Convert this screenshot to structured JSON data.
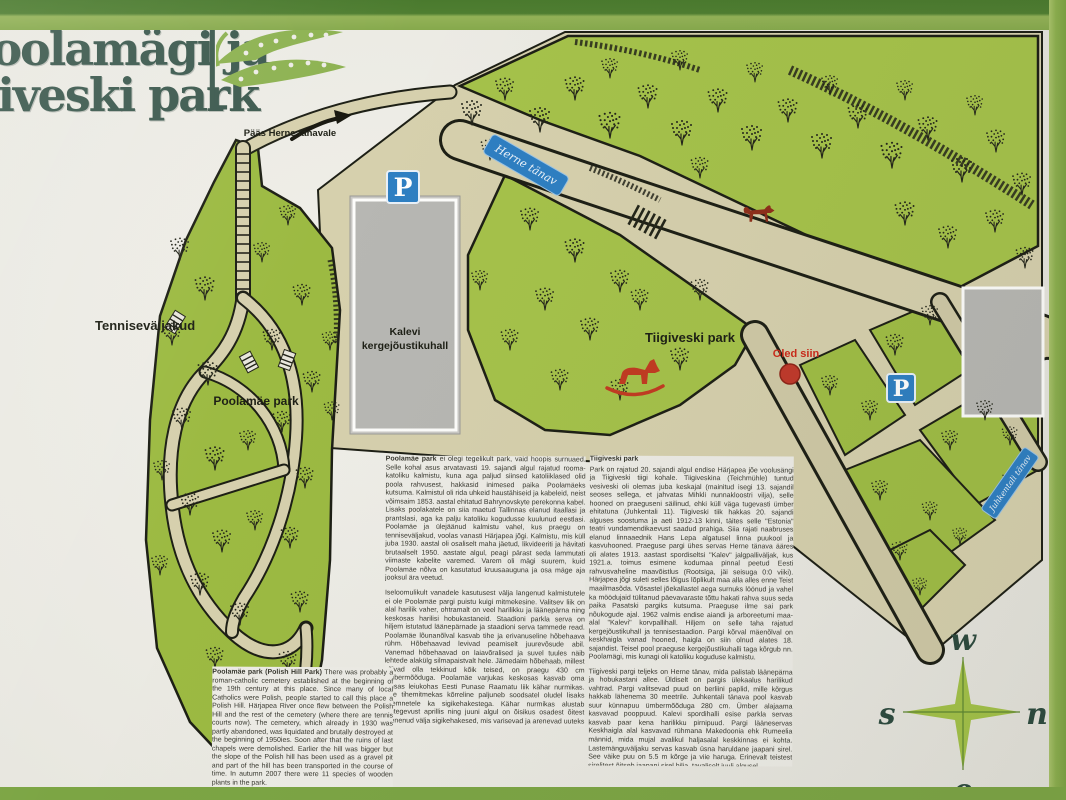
{
  "sign": {
    "title": {
      "line1": "Poolamägi ja",
      "line2": "Tiigiveski park"
    },
    "entrance_note": "Pääs Herne tänavale",
    "map": {
      "area_labels": {
        "tennis_courts": "Tenniseväljakud",
        "sports_hall_line1": "Kalevi",
        "sports_hall_line2": "kergejõustikuhall",
        "poolamae_park": "Poolamäe park",
        "tiigiveski_park": "Tiigiveski park"
      },
      "street_signs": {
        "herne": "Herne tänav",
        "juhkentali": "Juhkentali tänav"
      },
      "parking_symbol": "P",
      "you_are_here": "Oled siin",
      "compass": {
        "top": "w",
        "left": "s",
        "right": "n",
        "bottom": "e"
      }
    },
    "text_blocks": {
      "poolamae_et": {
        "lead": "Poolamäe park",
        "para1": "ei olegi tegelikult park, vaid hoopis surnuaed. Selle kohal asus arvatavasti 19. sajandi algul rajatud rooma-katoliku kalmistu, kuna aga paljud siinsed katoliiklased olid poola rahvusest, hakkasid inimesed paika Poolamäeks kutsuma. Kalmistul oli rida uhkeid haustähiseid ja kabeleid, neist võimsaim 1853. aastal ehitatud Bahrynovskyte perekonna kabel. Lisaks poolakatele on siia maetud Tallinnas elanud itaallasi ja prantslasi, aga ka palju katoliku kogudusse kuulunud eestlasi. Poolamäe ja ülejäänud kalmistu vahel, kus praegu on tenniseväljakud, voolas vanasti Härjapea jõgi. Kalmistu, mis küll juba 1930. aastal oli osaliselt maha jäetud, likvideeriti ja hävitati brutaalselt 1950. aastate algul, peagi pärast seda lammutati viimaste kabelite varemed. Varem oli mägi suurem, kuid Poolamäe nõlva on kasutatud kruusaauguna ja osa mäge aja jooksul ära veetud.",
        "para2": "Iseloomulikult vanadele kasutusest välja langenud kalmistutele ei ole Poolamäe pargi puistu kuigi mitmekesine. Valitsev liik on alal harilik vaher, ohtramalt on veel harilikku ja läänepärna ning keskosas harilisi hobukastaneid. Staadioni parkla serva on hiljem istutatud läänepärnade ja staadioni serva tammede read. Poolamäe lõunanõlval kasvab tihe ja erivanuseline hõbehaava rühm. Hõbehaavad levivad peamiselt juurevõsude abil. Vanemad hõbehaavad on laiavõralised ja suvel tuules näib lehtede alakülg silmapaistvalt hele. Jämedaim hõbehaab, millest võivad olla tekkinud kõik teised, on praegu 430 cm ümbermõõduga. Poolamäe varjukas keskosas kasvab oma ainsas leiukohas Eesti Punase Raamatu liik kähar nurmikas. See tihemitmekas kõrreline paljuneb soodsatel oludel lisaks seemnetele ka sigikehakestega. Kähar nurmikas alustab elutegevust aprillis ning juuni algul on õisikus osadest õitest arenenud välja sigikehakesed, mis varisevad ja arenevad uuteks taimedeks. Liigi säilimiseks ei tohiks pargi keskosas niita enne jaanipäeva.",
        "para3": "2007. a. sügisel kasvas pargis 11 nimetust puittaimi."
      },
      "tiigiveski_et": {
        "heading": "Tiigiveski park",
        "para1": "Park on rajatud 20. sajandi algul endise Härjapea jõe voolusängi ja Tiigiveski tiigi kohale. Tiigiveskina (Teichmühle) tuntud vesiveski oli olemas juba keskajal (mainitud isegi 13. sajandil seoses sellega, et jahvatas Mihkli nunnakloostri vilja), selle hooned on praeguseni säilinud, ehki küll väga tugevasti ümber ehitatuna (Juhkentali 11). Tiigiveski tiik hakkas 20. sajandi alguses soostuma ja aeti 1912-13 kinni, täites selle \"Estonia\" teatri vundamendikaevust saadud prahiga. Siia rajati naabruses elanud linnaaednik Hans Lepa algatusel linna puukool ja kasvuhooned. Praeguse pargi ühes servas Herne tänava ääres oli alates 1913. aastast spordiseltsi \"Kalev\" jalgpalliväljak, kus 1921.a. toimus esimene kodumaa pinnal peetud Eesti rahvusvaheline maavõistlus (Rootsiga, jäi seisuga 0:0 viiki). Härjapea jõgi suleti selles lõigus lõplikult maa alla alles enne Teist maailmasõda. Võsastel jõekallastel aega surnuks löönud ja vahel ka möödujaid tülitanud päevavaraste tõttu hakati rahva suus seda paika Pasatski pargiks kutsuma. Praeguse ilme sai park nõukogude ajal. 1962 valmis endise aiandi ja arboreetumi maa-alal \"Kalevi\" korvpallihall. Hiljem on selle taha rajatud kergejõustikuhall ja tennisestaadion. Pargi kõrval mäenõlval on keskhaigla vanad hooned, haigla on siin olnud alates 18. sajandist. Teisel pool praeguse kergejõustikuhalli taga kõrgub nn. Poolamägi, mis kunagi oli katoliku koguduse kalmistu.",
        "para2": "Tiigiveski pargi teljeks on Herne tänav, mida palistab läänepärna ja hobukastani allee. Üldiselt on pargis ülekaalus harilikud vahtrad. Pargi valitsevad puud on berliini paplid, mille kõrgus hakkab lähenema 30 meetrile. Juhkentali tänava pool kasvab suur künnapuu ümbermõõduga 280 cm. Ümber alajaama kasvavad pooppuud. Kalevi spordihalli esise parkla servas kasvab paar kena harilikku pirnipuud. Pargi lääneservas Keskhaigla alal kasvavad rühmana Makedoonia ehk Rumeelia männid, mida mujal avalikul haljasalal keskkinnas ei kohta. Lastemänguväljaku servas kasvab üsna haruldane jaapani sirel. See väike puu on 5.5 m kõrge ja viie haruga. Erinevalt teistest sirelitest õitseb jaapani sirel hilja, tavaliselt juuli algusel.",
        "para3": "2007. a. sügisel oli pargis 20 erinevat puittaime."
      },
      "poolamae_en": {
        "lead": "Poolamäe park (Polish Hill Park)",
        "para1": "There was probably a roman-catholic cemetery established at the beginning of the 19th century at this place. Since many of local Catholics were Polish, people started to call this place a Polish Hill. Härjapea River once flew between the Polish Hill and the rest of the cemetery (where there are tennis courts now). The cemetery, which already in 1930 was partly abandoned, was liquidated and brutally destroyed at the beginning of 1950ies. Soon after that the ruins of last chapels were demolished. Earlier the hill was bigger but the slope of the Polish hill has been used as a gravel pit and part of the hill has been transported in the course of time. In autumn 2007 there were 11 species of wooden plants in the park."
      }
    },
    "colors": {
      "frame_green": "#8fb054",
      "frame_green_dark": "#4a7a2e",
      "map_green": "#a5c24a",
      "path_beige": "#d6d0ad",
      "sign_blue": "#2e7fc2",
      "marker_red": "#c0392b",
      "title_green": "#3d5a4f"
    }
  }
}
